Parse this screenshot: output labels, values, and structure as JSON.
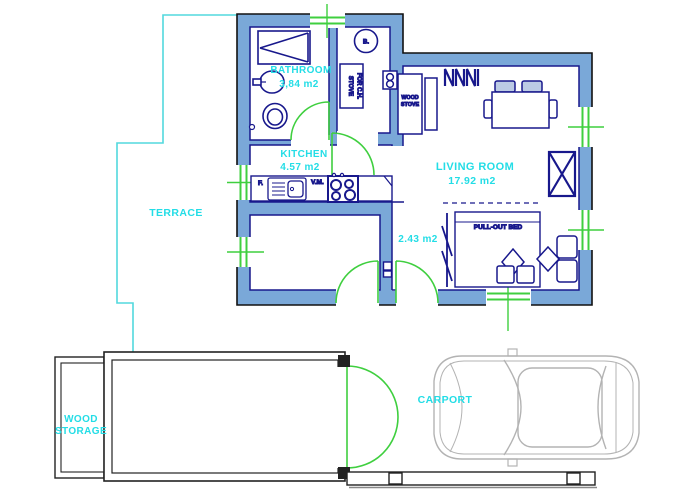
{
  "plan": {
    "rooms": {
      "bathroom": {
        "label": "BATHROOM",
        "area": "3,84 m2"
      },
      "kitchen": {
        "label": "KITCHEN",
        "area": "4.57 m2"
      },
      "living_room": {
        "label": "LIVING ROOM",
        "area": "17.92 m2"
      },
      "hall": {
        "area": "2.43 m2"
      },
      "terrace": {
        "label": "TERRACE"
      },
      "wood_storage": {
        "label_line1": "WOOD",
        "label_line2": "STORAGE"
      },
      "carport": {
        "label": "CARPORT"
      }
    },
    "fixtures": {
      "boiler": "B.",
      "stove_ch_line1": "STOVE",
      "stove_ch_line2": "FOR C.H.",
      "wood_stove_line1": "WOOD",
      "wood_stove_line2": "STOVE",
      "fridge": "F.",
      "washing_machine": "V.M.",
      "pull_out_bed": "PULL-OUT BED"
    },
    "colors": {
      "wall_fill": "#7aa8d8",
      "wall_outline": "#111111",
      "furniture": "#18188c",
      "label_cyan": "#23dde6",
      "door_window_green": "#3fcf3f",
      "terrace_line": "#52d9dd",
      "car_outline": "#b3b3b3"
    }
  }
}
